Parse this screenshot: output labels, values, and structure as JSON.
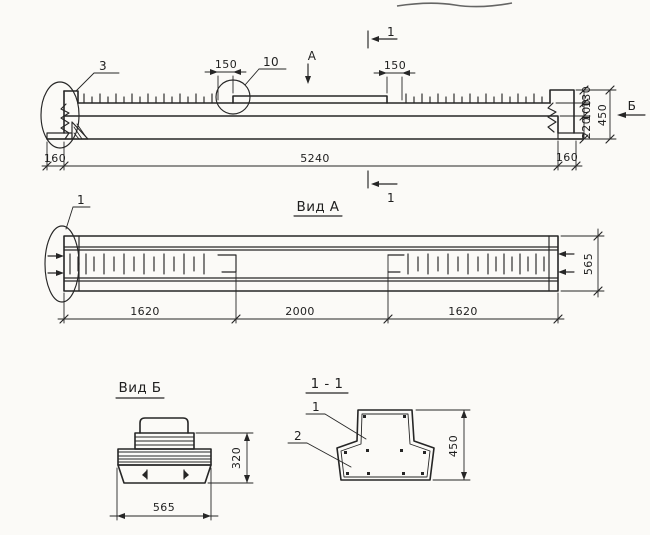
{
  "colors": {
    "ink": "#262626",
    "paper": "#fbfaf7"
  },
  "elevation": {
    "callout_3": "3",
    "callout_10": "10",
    "dim_step_left": "150",
    "dim_step_right": "150",
    "view_dir_a": "А",
    "view_dir_b": "Б",
    "section_cut_top": "1",
    "section_cut_bottom": "1",
    "dim_h_130": "130",
    "dim_h_100": "100",
    "dim_h_220": "220",
    "dim_h_450": "450",
    "dim_end_left": "160",
    "dim_length": "5240",
    "dim_end_right": "160"
  },
  "plan_view": {
    "title": "Вид А",
    "callout_1": "1",
    "dim_zone_left": "1620",
    "dim_zone_middle": "2000",
    "dim_zone_right": "1620",
    "dim_width": "565"
  },
  "end_view": {
    "title": "Вид Б",
    "dim_height": "320",
    "dim_width": "565"
  },
  "section_1_1": {
    "title": "1 - 1",
    "callout_1": "1",
    "callout_2": "2",
    "dim_height": "450"
  }
}
